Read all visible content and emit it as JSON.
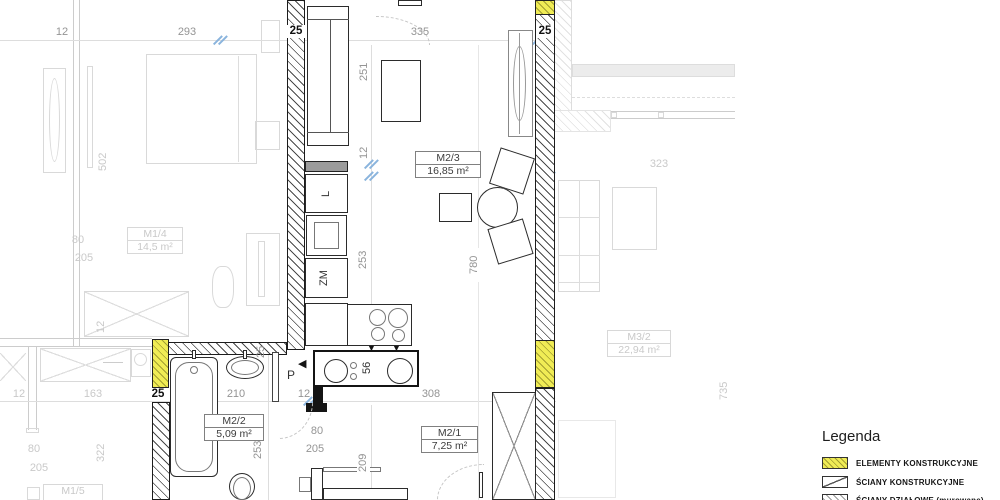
{
  "dims": {
    "t12": "12",
    "t293": "293",
    "t25a": "25",
    "t335": "335",
    "t25b": "25",
    "v251": "251",
    "v12": "12",
    "v253": "253",
    "v780": "780",
    "v25": "25",
    "h210": "210",
    "h12": "12",
    "h308": "308",
    "v56": "56",
    "v253b": "253",
    "h80": "80",
    "h205": "205",
    "v209": "209",
    "b25": "25",
    "f502": "502",
    "f80": "80",
    "f205": "205",
    "f12v": "12",
    "f12": "12",
    "f163": "163",
    "f80b": "80",
    "f205b": "205",
    "f322": "322",
    "f323": "323",
    "f735": "735"
  },
  "rooms": {
    "m23": {
      "id": "M2/3",
      "area": "16,85 m²"
    },
    "m22": {
      "id": "M2/2",
      "area": "5,09 m²"
    },
    "m21": {
      "id": "M2/1",
      "area": "7,25 m²"
    },
    "m14": {
      "id": "M1/4",
      "area": "14,5 m²"
    },
    "m32": {
      "id": "M3/2",
      "area": "22,94 m²"
    },
    "m15": {
      "id": "M1/5"
    }
  },
  "kitchen": {
    "fridge_label": "L",
    "dishwasher_label": "ZM"
  },
  "hall": {
    "label": "P"
  },
  "icons": {
    "down_arrow": "▼",
    "entry_arrow": "◀"
  },
  "legend": {
    "title": "Legenda",
    "items": [
      {
        "swatch": "yellow-hatch",
        "label": "ELEMENTY KONSTRUKCYJNE"
      },
      {
        "swatch": "diagonal-hatch",
        "label": "ŚCIANY KONSTRUKCYJNE"
      },
      {
        "swatch": "partition-hatch",
        "label": "ŚCIANY DZIAŁOWE (murowane)"
      }
    ]
  },
  "colors": {
    "structural_yellow": "#f0ec55",
    "wall_line": "#1c1c1c",
    "faint_line": "#d9d9d9",
    "dim_text": "#949494",
    "break_mark_blue": "#8ab4dd"
  }
}
